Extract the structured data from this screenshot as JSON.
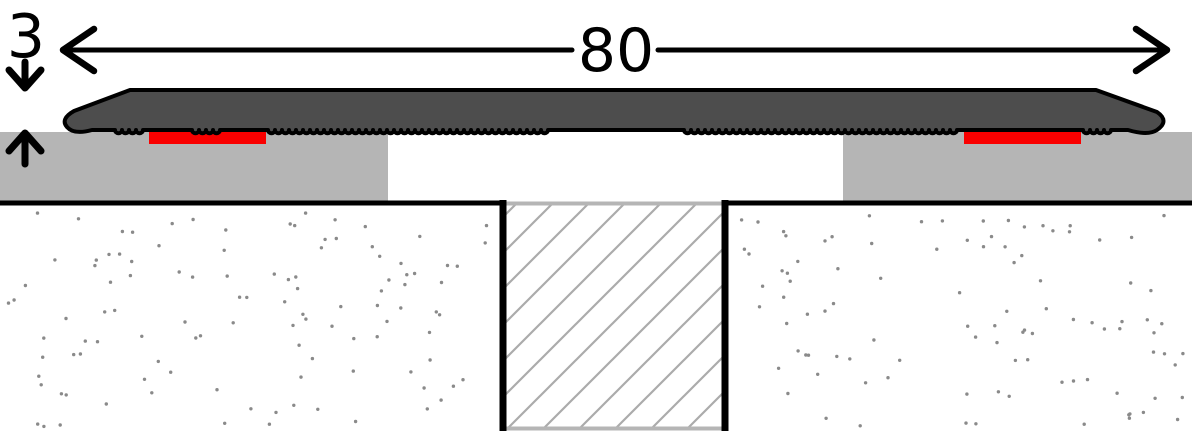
{
  "diagram": {
    "kind": "floor-profile cross-section",
    "dimensions": {
      "width": {
        "label": "80"
      },
      "height": {
        "label": "3"
      }
    },
    "parts": {
      "profile": "cover-profile",
      "adhesive_left": "adhesive-strip-left",
      "adhesive_right": "adhesive-strip-right",
      "covering_left": "floor-covering-left",
      "covering_right": "floor-covering-right",
      "base": "screed-base",
      "joint": "expansion-joint"
    }
  },
  "colors": {
    "outline": "#000000",
    "profile_body": "#4d4d4d",
    "floor_covering": "#b5b5b5",
    "adhesive": "#f90000",
    "joint_hatch": "#ababab",
    "joint_border": "#b5b5b5",
    "stipple_dots": "#8a8a8a",
    "background": "#ffffff"
  }
}
